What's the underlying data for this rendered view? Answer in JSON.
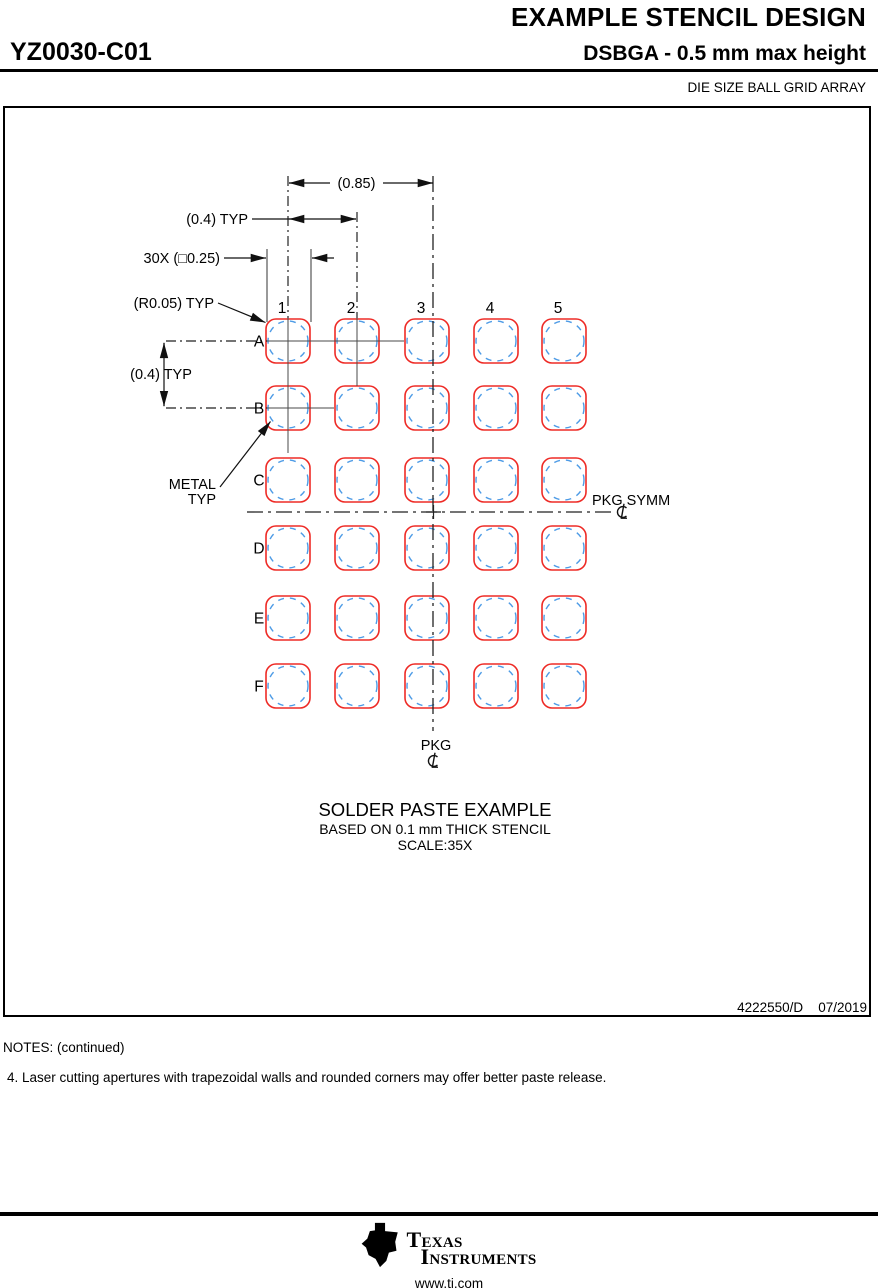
{
  "header": {
    "title": "EXAMPLE STENCIL DESIGN",
    "part_number": "YZ0030-C01",
    "subtitle": "DSBGA - 0.5 mm max height",
    "package_type": "DIE SIZE BALL GRID ARRAY"
  },
  "drawing": {
    "dim_pitch_085": "(0.85)",
    "dim_pitch_04_h": "(0.4) TYP",
    "dim_aperture": "30X (□0.25)",
    "dim_radius": "(R0.05) TYP",
    "dim_pitch_04_v": "(0.4) TYP",
    "metal_label_line1": "METAL",
    "metal_label_line2": "TYP",
    "pkg_symm_label": "PKG SYMM",
    "pkg_label": "PKG",
    "caption_title": "SOLDER PASTE EXAMPLE",
    "caption_line2": "BASED ON 0.1 mm THICK STENCIL",
    "caption_line3": "SCALE:35X",
    "doc_id": "4222550/D",
    "doc_date": "07/2019"
  },
  "grid": {
    "col_labels": [
      "1",
      "2",
      "3",
      "4",
      "5"
    ],
    "row_labels": [
      "A",
      "B",
      "C",
      "D",
      "E",
      "F"
    ],
    "col_x": [
      288,
      357,
      427,
      496,
      564
    ],
    "row_y": [
      341,
      408,
      480,
      548,
      618,
      686
    ],
    "pad_size": 44,
    "pad_radius": 10,
    "ball_diameter": 40,
    "pad_color": "#ee2b26",
    "ball_color": "#4d9be6"
  },
  "notes": {
    "heading": "NOTES: (continued)",
    "note4": "4. Laser cutting apertures with trapezoidal walls and rounded corners may offer better paste release."
  },
  "footer": {
    "brand_line1": "Texas",
    "brand_line2": "Instruments",
    "url": "www.ti.com"
  }
}
